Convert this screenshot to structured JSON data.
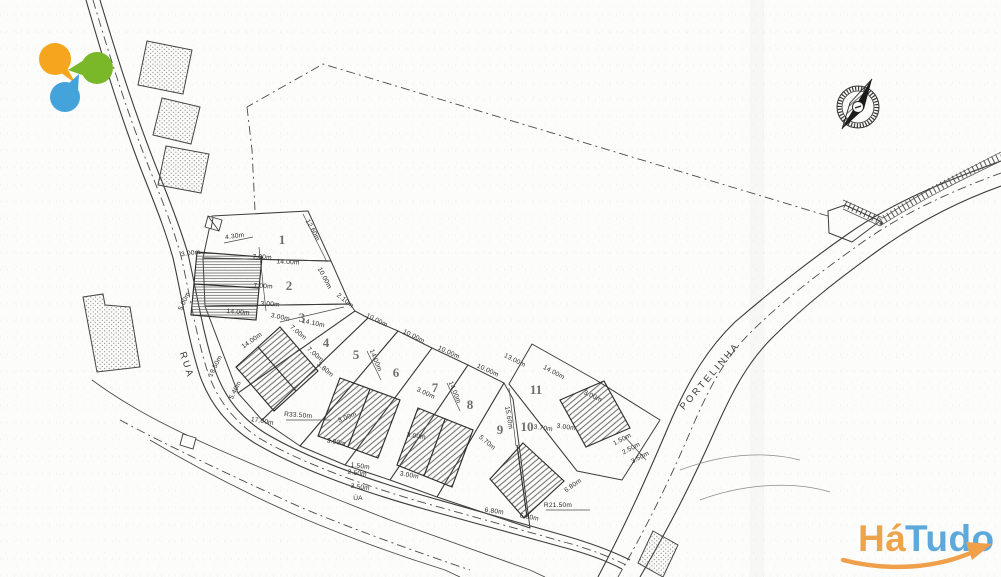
{
  "page": {
    "width": 1001,
    "height": 577
  },
  "branding": {
    "bubbles": {
      "orange": "#F5A61E",
      "green": "#7AB829",
      "blue": "#45A3DC"
    },
    "watermark": {
      "ha": "Há",
      "tudo": "Tudo",
      "ha_color": "#ECA44D",
      "tudo_color": "#5EA9DC",
      "swoosh_color": "#F0A04B"
    }
  },
  "plan": {
    "road_labels": [
      {
        "text": "RUA",
        "x": 184,
        "y": 366,
        "rot": 72
      },
      {
        "text": "PORTELINHA",
        "x": 712,
        "y": 378,
        "rot": -49
      }
    ],
    "lot_numbers": [
      {
        "text": "1",
        "x": 282,
        "y": 244
      },
      {
        "text": "2",
        "x": 289,
        "y": 290
      },
      {
        "text": "3",
        "x": 302,
        "y": 322
      },
      {
        "text": "4",
        "x": 326,
        "y": 347
      },
      {
        "text": "5",
        "x": 356,
        "y": 359
      },
      {
        "text": "6",
        "x": 396,
        "y": 377
      },
      {
        "text": "7",
        "x": 435,
        "y": 392
      },
      {
        "text": "8",
        "x": 470,
        "y": 409
      },
      {
        "text": "9",
        "x": 500,
        "y": 434
      },
      {
        "text": "10",
        "x": 527,
        "y": 431
      },
      {
        "text": "11",
        "x": 536,
        "y": 394
      }
    ],
    "dimensions": [
      {
        "text": "4.30m",
        "x": 235,
        "y": 238,
        "rot": -8
      },
      {
        "text": "12.60m",
        "x": 311,
        "y": 231,
        "rot": 62
      },
      {
        "text": "3.00m",
        "x": 191,
        "y": 255,
        "rot": -8
      },
      {
        "text": "7.00m",
        "x": 262,
        "y": 259,
        "rot": 3
      },
      {
        "text": "14.00m",
        "x": 288,
        "y": 264,
        "rot": 3
      },
      {
        "text": "10.00m",
        "x": 323,
        "y": 279,
        "rot": 62
      },
      {
        "text": "7.00m",
        "x": 263,
        "y": 288,
        "rot": 3
      },
      {
        "text": "3.00m",
        "x": 270,
        "y": 306,
        "rot": 3
      },
      {
        "text": "14.00m",
        "x": 238,
        "y": 314,
        "rot": 5
      },
      {
        "text": "2.10m",
        "x": 344,
        "y": 302,
        "rot": 38
      },
      {
        "text": "5.00m",
        "x": 186,
        "y": 302,
        "rot": -65
      },
      {
        "text": "14.10m",
        "x": 313,
        "y": 325,
        "rot": 12
      },
      {
        "text": "3.00m",
        "x": 280,
        "y": 319,
        "rot": 12
      },
      {
        "text": "7.00m",
        "x": 297,
        "y": 334,
        "rot": 40
      },
      {
        "text": "7.00m",
        "x": 314,
        "y": 356,
        "rot": 40
      },
      {
        "text": "14.00m",
        "x": 253,
        "y": 342,
        "rot": -35
      },
      {
        "text": "3.80m",
        "x": 324,
        "y": 371,
        "rot": 40
      },
      {
        "text": "19.50m",
        "x": 217,
        "y": 367,
        "rot": -63
      },
      {
        "text": "5.40m",
        "x": 237,
        "y": 391,
        "rot": -63
      },
      {
        "text": "R33.50m",
        "x": 298,
        "y": 417,
        "rot": 4
      },
      {
        "text": "17.00m",
        "x": 262,
        "y": 423,
        "rot": 10
      },
      {
        "text": "10.00m",
        "x": 376,
        "y": 322,
        "rot": 27
      },
      {
        "text": "10.00m",
        "x": 413,
        "y": 338,
        "rot": 26
      },
      {
        "text": "14.00m",
        "x": 374,
        "y": 361,
        "rot": 68
      },
      {
        "text": "3.00m",
        "x": 425,
        "y": 395,
        "rot": 25
      },
      {
        "text": "3.00m",
        "x": 348,
        "y": 419,
        "rot": -22
      },
      {
        "text": "3.00m",
        "x": 416,
        "y": 438,
        "rot": 8
      },
      {
        "text": "10.00m",
        "x": 448,
        "y": 354,
        "rot": 25
      },
      {
        "text": "10.00m",
        "x": 487,
        "y": 372,
        "rot": 25
      },
      {
        "text": "14.00m",
        "x": 453,
        "y": 393,
        "rot": 68
      },
      {
        "text": "13.00m",
        "x": 514,
        "y": 362,
        "rot": 27
      },
      {
        "text": "15.60m",
        "x": 507,
        "y": 418,
        "rot": 80
      },
      {
        "text": "3.70m",
        "x": 543,
        "y": 430,
        "rot": 8
      },
      {
        "text": "14.00m",
        "x": 553,
        "y": 374,
        "rot": 28
      },
      {
        "text": "3.00m",
        "x": 592,
        "y": 398,
        "rot": 25
      },
      {
        "text": "3.00m",
        "x": 566,
        "y": 429,
        "rot": 8
      },
      {
        "text": "5.70m",
        "x": 486,
        "y": 444,
        "rot": 40
      },
      {
        "text": "6.80m",
        "x": 574,
        "y": 487,
        "rot": -35
      },
      {
        "text": "6.80m",
        "x": 494,
        "y": 513,
        "rot": 8
      },
      {
        "text": "6.80m",
        "x": 529,
        "y": 519,
        "rot": 10
      },
      {
        "text": "R21.50m",
        "x": 558,
        "y": 507,
        "rot": 0
      },
      {
        "text": "1.50m",
        "x": 623,
        "y": 441,
        "rot": -28
      },
      {
        "text": "2.50m",
        "x": 632,
        "y": 450,
        "rot": -28
      },
      {
        "text": "3.50m",
        "x": 641,
        "y": 459,
        "rot": -28
      },
      {
        "text": "3.00m",
        "x": 336,
        "y": 444,
        "rot": 10
      },
      {
        "text": "1.50m",
        "x": 360,
        "y": 468,
        "rot": 8
      },
      {
        "text": "2.50m",
        "x": 357,
        "y": 475,
        "rot": 8
      },
      {
        "text": "3.50m",
        "x": 360,
        "y": 489,
        "rot": 8
      },
      {
        "text": "ÚA",
        "x": 358,
        "y": 500,
        "rot": 0
      },
      {
        "text": "3.00m",
        "x": 409,
        "y": 477,
        "rot": 10
      }
    ]
  }
}
